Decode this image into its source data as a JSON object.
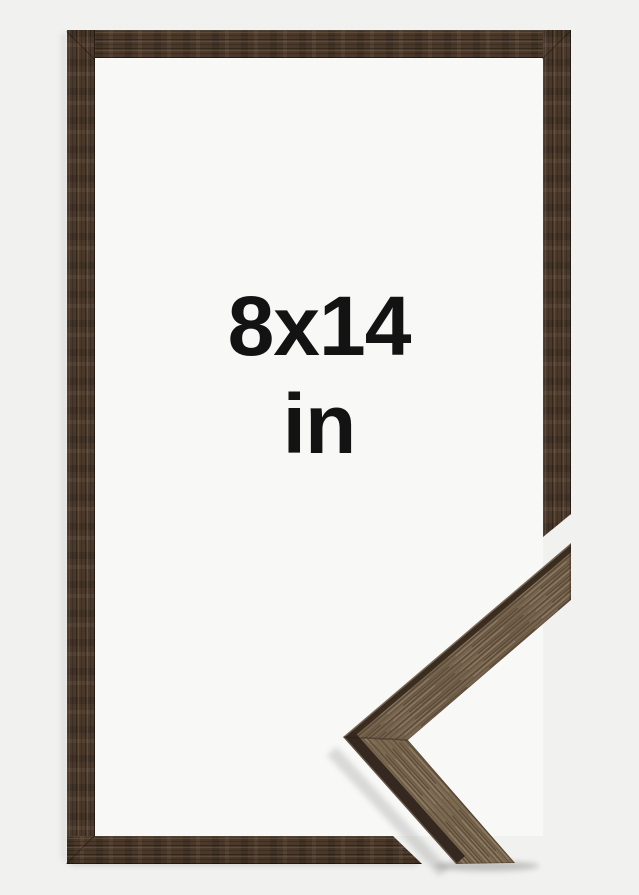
{
  "size_label": {
    "dimensions": "8x14",
    "unit": "in"
  },
  "colors": {
    "bg-outer": "#f1f1f0",
    "bg-opening": "#f8f8f7",
    "wood-dark": "#4a392b",
    "wood-face": "#7c6a53",
    "wood-side": "#392c20",
    "text": "#131313"
  }
}
